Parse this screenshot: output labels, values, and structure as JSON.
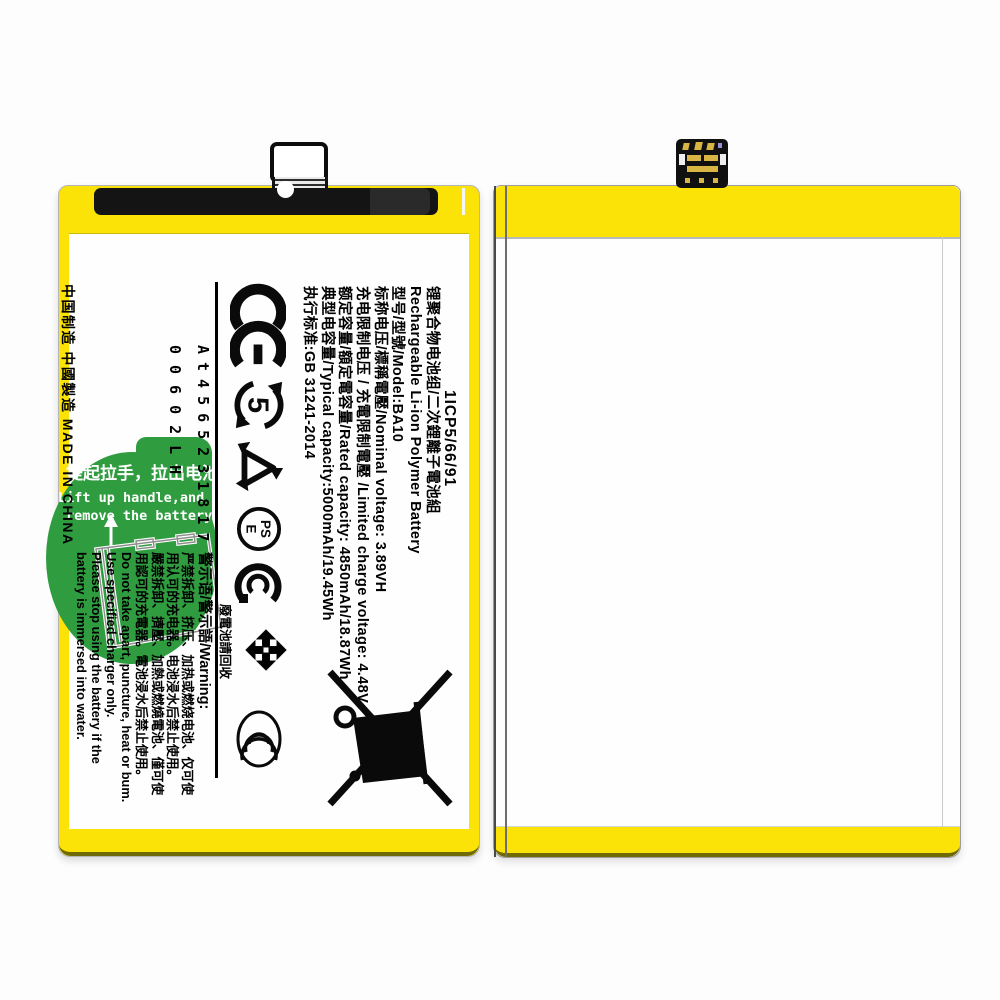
{
  "colors": {
    "battery_yellow": "#FBE308",
    "pull_tab_green": "#2F9C3F",
    "tape_black": "#141414",
    "connector_gold": "#D9B544",
    "label_text": "#000000"
  },
  "battery_front": {
    "spec_lines": [
      "1ICP5/66/91",
      "锂聚合物电池组/二次鋰離子電池組",
      "Rechargeable Li-ion Polymer Battery",
      "型号/型號/Model:BA10",
      "标称电压/標稱電壓/Nominal voltage: 3.89VH",
      "充电限制电压 / 充電限制電壓 /Limited charge voltage: 4.48V",
      "额定容量/額定電容量/Rated capacity: 4850mAh/18.87Wh",
      "典型电容量/Typical capacity:5000mAh/19.45Wh",
      "执行标准:GB 31241-2014"
    ],
    "serial_line_1": "At4565231817",
    "serial_line_2": "00602LH",
    "made_in": "中国制造 中國製造 MADE IN CHINA",
    "warning_header": "警示语/警示語/Warning:",
    "warning_lines": [
      "严禁拆卸、挤压、加热或燃烧电池、仅可使",
      "用认可的充电器。电池浸水后禁止使用。",
      "嚴禁拆卸、擠壓、加熱或燃燒電池、僅可使",
      "用認可的充電器。電池浸水后禁止使用。",
      "Do not take apart, puncture, heat or bum.",
      "Use specified charger only.",
      "Please stop using the battery if the",
      "battery is immersed into water."
    ],
    "efup_value": "5",
    "pse_top": "PS",
    "pse_bottom": "E",
    "recycle_caption": "廢電池請回收",
    "green_tab": {
      "line_cn": "提起拉手，拉出电池",
      "line_en_1": "Lift up handle,and",
      "line_en_2": "remove the battery"
    }
  }
}
